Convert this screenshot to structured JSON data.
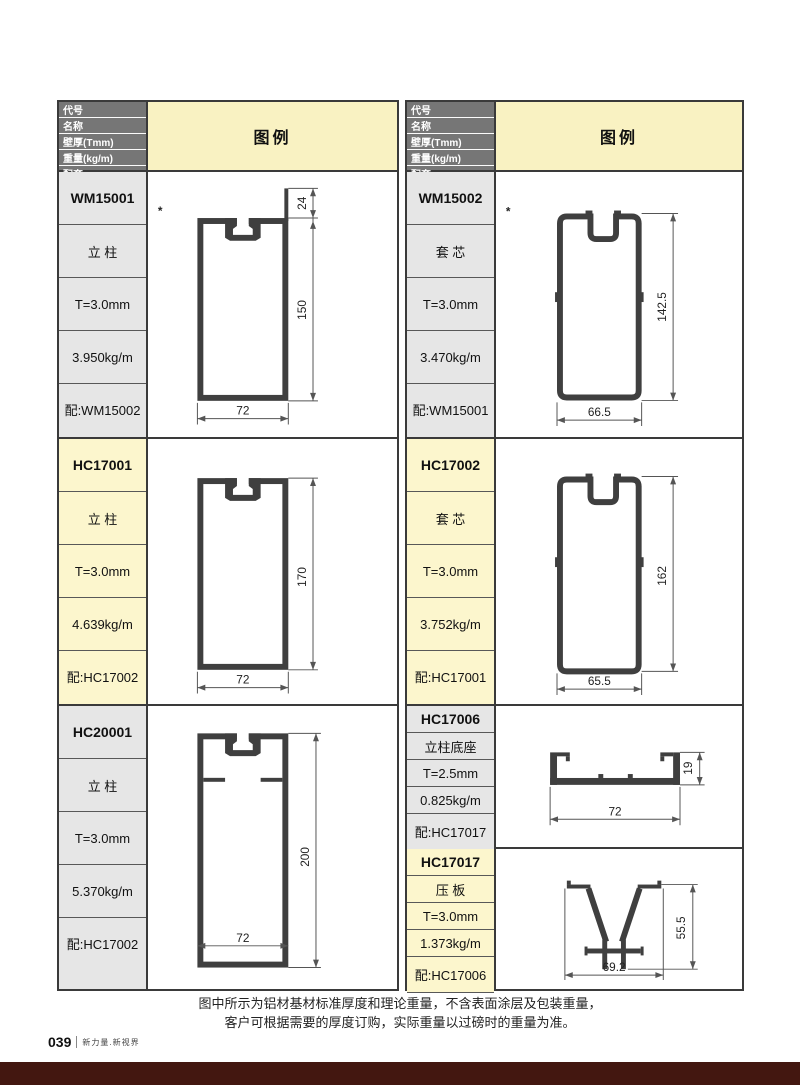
{
  "page": {
    "note_line1": "图中所示为铝材基材标准厚度和理论重量，不含表面涂层及包装重量，",
    "note_line2": "客户可根据需要的厚度订购，实际重量以过磅时的重量为准。",
    "footer_page": "039",
    "footer_brand": "新力量.新视界"
  },
  "colors": {
    "header_gray": "#767676",
    "legend_yellow": "#f9f2c2",
    "cell_gray": "#e6e6e6",
    "cell_yellow": "#fcf6cd",
    "bottom_bar": "#431710",
    "profile_stroke": "#3f3f3f"
  },
  "header": {
    "rows": [
      "代号",
      "名称",
      "壁厚(Tmm)",
      "重量(kg/m)",
      "配套"
    ],
    "legend": "图例"
  },
  "columns": [
    {
      "entries": [
        {
          "code": "WM15001",
          "name": "立 柱",
          "thickness": "T=3.0mm",
          "weight": "3.950kg/m",
          "match": "配:WM15002",
          "star": "*",
          "dims": {
            "fin": "24",
            "height": "150",
            "width": "72"
          }
        },
        {
          "code": "HC17001",
          "name": "立 柱",
          "thickness": "T=3.0mm",
          "weight": "4.639kg/m",
          "match": "配:HC17002",
          "dims": {
            "height": "170",
            "width": "72"
          }
        },
        {
          "code": "HC20001",
          "name": "立 柱",
          "thickness": "T=3.0mm",
          "weight": "5.370kg/m",
          "match": "配:HC17002",
          "dims": {
            "height": "200",
            "width": "72"
          }
        }
      ]
    },
    {
      "entries": [
        {
          "code": "WM15002",
          "name": "套 芯",
          "thickness": "T=3.0mm",
          "weight": "3.470kg/m",
          "match": "配:WM15001",
          "star": "*",
          "dims": {
            "height": "142.5",
            "width": "66.5"
          }
        },
        {
          "code": "HC17002",
          "name": "套 芯",
          "thickness": "T=3.0mm",
          "weight": "3.752kg/m",
          "match": "配:HC17001",
          "dims": {
            "height": "162",
            "width": "65.5"
          }
        },
        {
          "code": "HC17006",
          "name": "立柱底座",
          "thickness": "T=2.5mm",
          "weight": "0.825kg/m",
          "match": "配:HC17017",
          "dims": {
            "height": "19",
            "width": "72"
          }
        },
        {
          "code": "HC17017",
          "name": "压 板",
          "thickness": "T=3.0mm",
          "weight": "1.373kg/m",
          "match": "配:HC17006",
          "dims": {
            "height": "55.5",
            "width": "69.2"
          }
        }
      ]
    }
  ]
}
